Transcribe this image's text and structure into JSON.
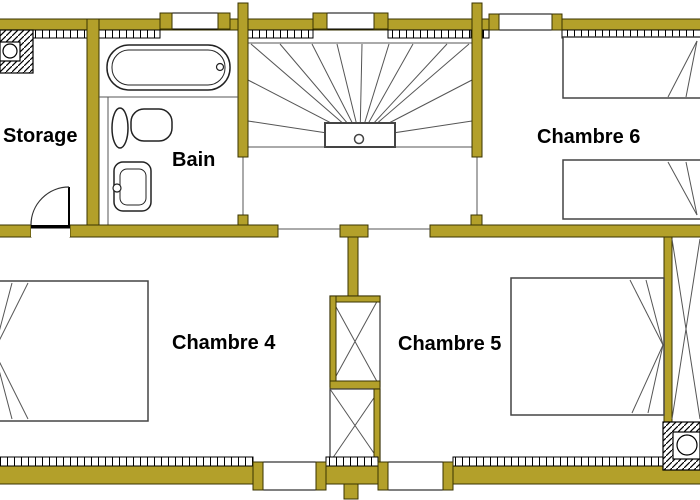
{
  "plan": {
    "rooms": {
      "storage": {
        "label": "Storage"
      },
      "bain": {
        "label": "Bain"
      },
      "chambre4": {
        "label": "Chambre 4"
      },
      "chambre5": {
        "label": "Chambre 5"
      },
      "chambre6": {
        "label": "Chambre 6"
      }
    },
    "fixtures": [
      "bathtub",
      "toilet",
      "sink",
      "door-swing",
      "winder-staircase",
      "stair-landing",
      "bed-chambre4",
      "bed-chambre5",
      "bed-chambre6-top",
      "bed-chambre6-bottom",
      "chimney-top-left",
      "chimney-bottom-right",
      "duct-shaft",
      "window",
      "roof-slope-lines"
    ]
  },
  "colors": {
    "wall": "#b3a02a",
    "wall_edge": "#3a3300",
    "line": "#555555",
    "ink": "#000000",
    "bg": "#ffffff"
  }
}
